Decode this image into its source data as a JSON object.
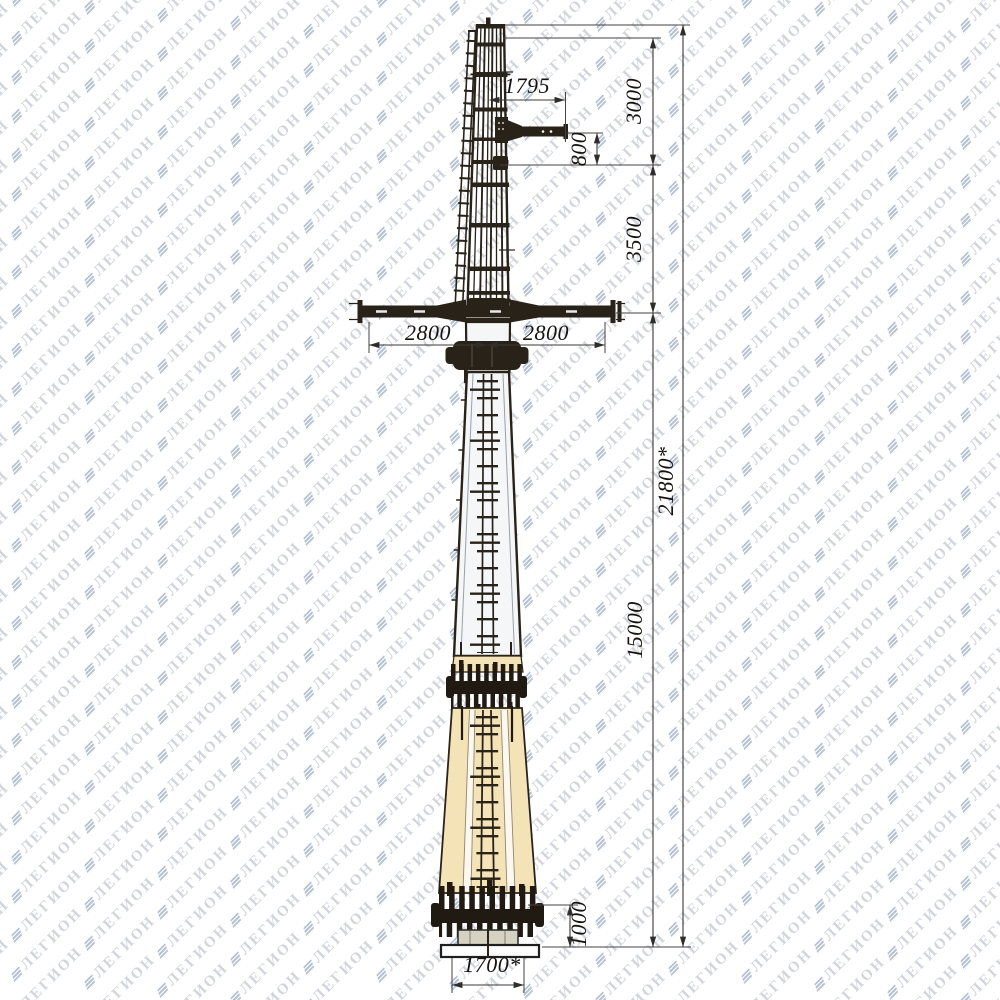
{
  "watermark": {
    "text": "ЛЕГИОН",
    "color": "rgba(152,161,176,0.45)",
    "icon_color": "#96a8be"
  },
  "drawing": {
    "labels": {
      "dim_1795": "1795",
      "dim_3000": "3000",
      "dim_800": "800",
      "dim_3500": "3500",
      "dim_2800_left": "2800",
      "dim_2800_right": "2800",
      "dim_21800": "21800*",
      "dim_15000": "15000",
      "dim_1000": "1000",
      "dim_1700": "1700*"
    },
    "colors": {
      "structure": "#292219",
      "pole_light": "#f5f6f8",
      "pole_tan": "#f4e3b6",
      "base_stub": "#d6d2c1",
      "dimension_line": "#3c3a36",
      "label_text": "#15130f"
    }
  }
}
